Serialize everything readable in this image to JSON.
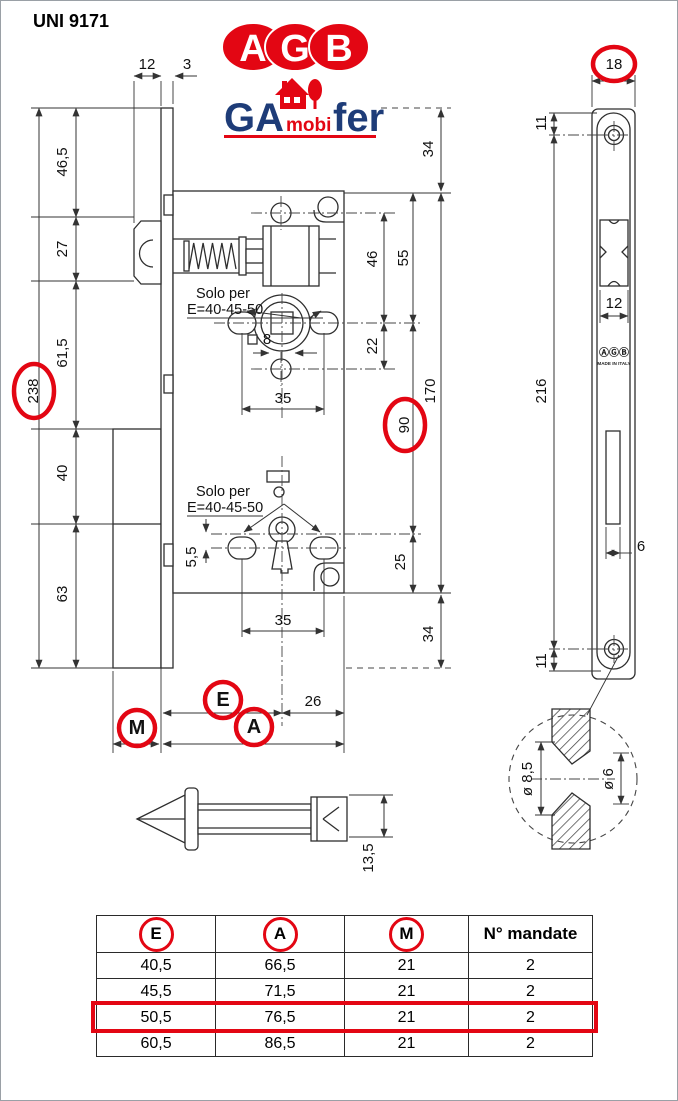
{
  "page": {
    "standard": "UNI 9171"
  },
  "logos": {
    "agb_letters": [
      "A",
      "G",
      "B"
    ],
    "gamobifer": {
      "ga": "GA",
      "mobi": "mobi",
      "fer": "fer"
    },
    "agb_red": "#e30613",
    "gamobifer_blue": "#1e3c78"
  },
  "side_view": {
    "notes": {
      "solo_per": "Solo per",
      "e_range": "E=40-45-50"
    },
    "dims": {
      "case_depth_top": "12",
      "plate_thickness": "3",
      "top_to_latch": "46,5",
      "latch_height": "27",
      "latch_to_deadbolt": "61,5",
      "plate_length": "238",
      "deadbolt_upper": "40",
      "deadbolt_lower": "63",
      "plate_top_to_case": "34",
      "case_top_to_hub": "55",
      "hole_to_hub": "46",
      "hub_to_hole": "22",
      "case_height": "170",
      "hub_to_key": "90",
      "key_to_case_bottom": "25",
      "case_bottom_to_plate": "34",
      "screws_span_top": "35",
      "screws_span_bottom": "35",
      "square_follower": "8",
      "key_offset": "5,5",
      "center_to_back": "26"
    },
    "callouts": {
      "E": "E",
      "A": "A",
      "M": "M"
    }
  },
  "front_view": {
    "dims": {
      "plate_width": "18",
      "top_to_screw": "11",
      "latch_width": "12",
      "screw_span": "216",
      "key_slot_width": "6",
      "screw_to_bottom": "11"
    },
    "stamp": {
      "logo": "ⒶⒼⒷ",
      "made_in": "MADE IN ITALY"
    }
  },
  "detail_view": {
    "countersink_outer": "ø 8,5",
    "countersink_inner": "ø 6"
  },
  "spindle_view": {
    "height": "13,5"
  },
  "table": {
    "headers": [
      "E",
      "A",
      "M",
      "N° mandate"
    ],
    "rows": [
      [
        "40,5",
        "66,5",
        "21",
        "2"
      ],
      [
        "45,5",
        "71,5",
        "21",
        "2"
      ],
      [
        "50,5",
        "76,5",
        "21",
        "2"
      ],
      [
        "60,5",
        "86,5",
        "21",
        "2"
      ]
    ],
    "highlighted_row_index": 2,
    "highlight_color": "#e30613"
  }
}
